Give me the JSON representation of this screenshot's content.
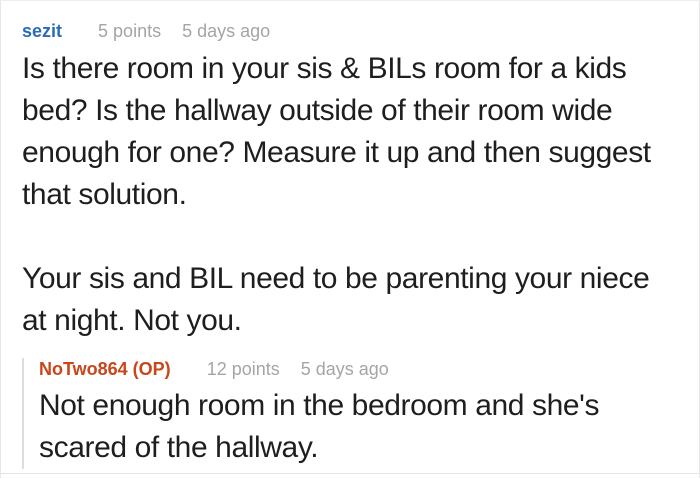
{
  "colors": {
    "username_blue": "#2c6cb3",
    "username_orange": "#c9451a",
    "meta_gray": "#a5a5a5",
    "body_text": "#1e1e1e",
    "card_border": "#e7e7e7",
    "thread_line": "#dddddd"
  },
  "comment": {
    "username": "sezit",
    "points": "5 points",
    "time": "5 days ago",
    "body": "Is there room in your sis & BILs room for a kids\nbed? Is the hallway outside of their room wide\nenough for one? Measure it up and then suggest\nthat solution.\n\nYour sis and BIL need to be parenting your niece\nat night. Not you."
  },
  "reply": {
    "username": "NoTwo864 (OP)",
    "points": "12 points",
    "time": "5 days ago",
    "body": "Not enough room in the bedroom and she's\nscared of the hallway."
  }
}
